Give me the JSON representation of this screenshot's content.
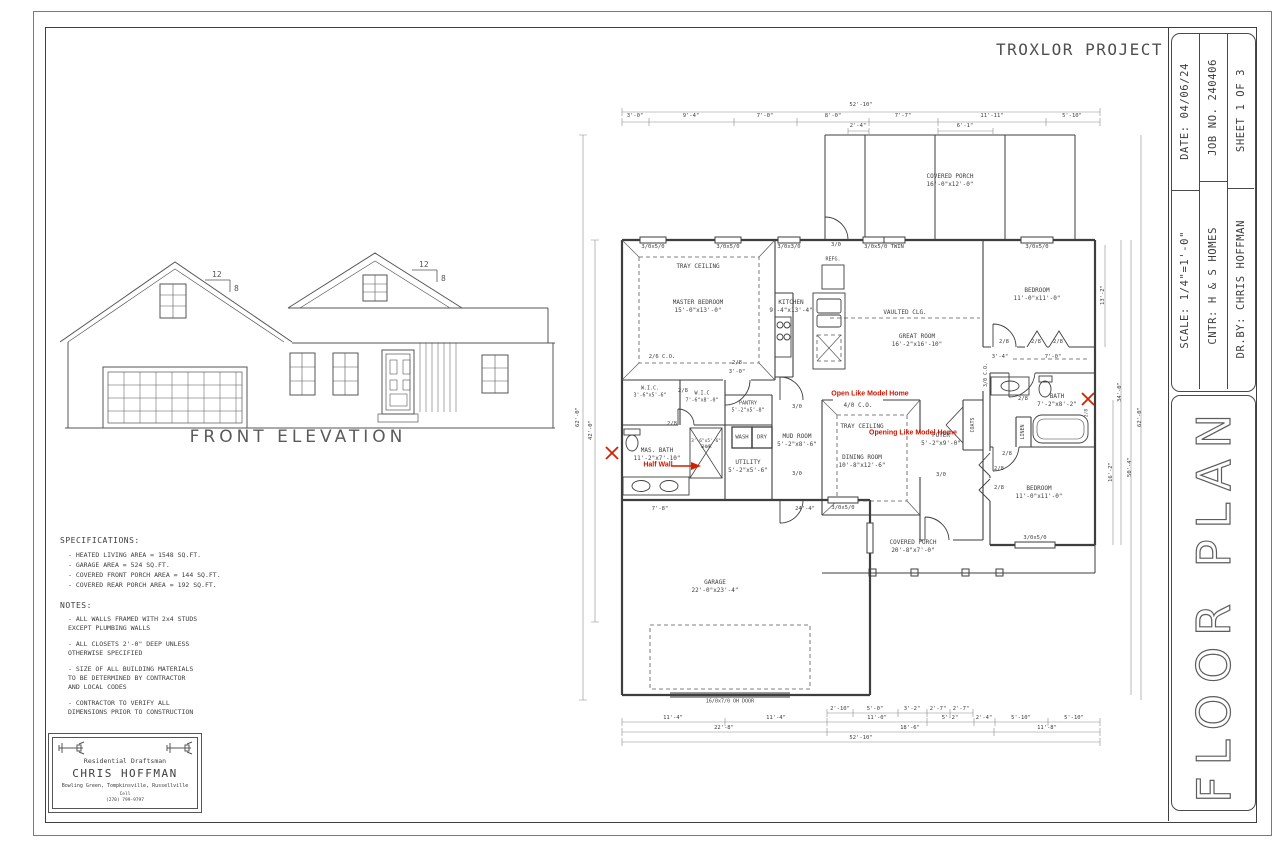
{
  "sheet": {
    "project_title": "TROXLOR PROJECT",
    "title_block": {
      "date_label": "DATE: 04/06/24",
      "job_label": "JOB NO. 240406",
      "sheet_label": "SHEET 1 OF 3",
      "scale_label": "SCALE: 1/4\"=1'-0\"",
      "contractor_label": "CNTR: H & S HOMES",
      "drawn_by_label": "DR.BY: CHRIS HOFFMAN",
      "drawing_title": "FLOOR PLAN"
    },
    "elevation": {
      "label": "FRONT ELEVATION",
      "pitch_rise": "12",
      "pitch_run": "8"
    },
    "specifications": {
      "heading": "SPECIFICATIONS:",
      "items": [
        "- HEATED LIVING AREA = 1548 SQ.FT.",
        "- GARAGE AREA = 524 SQ.FT.",
        "- COVERED FRONT PORCH AREA = 144 SQ.FT.",
        "- COVERED REAR PORCH AREA = 192 SQ.FT."
      ]
    },
    "notes": {
      "heading": "NOTES:",
      "items": [
        "- ALL WALLS FRAMED WITH 2x4 STUDS\n  EXCEPT PLUMBING WALLS",
        "- ALL CLOSETS 2'-0\" DEEP UNLESS\n  OTHERWISE SPECIFIED",
        "- SIZE OF ALL BUILDING MATERIALS\n  TO BE DETERMINED BY CONTRACTOR\n  AND LOCAL CODES",
        "- CONTRACTOR TO VERIFY ALL\n  DIMENSIONS PRIOR TO CONSTRUCTION"
      ]
    },
    "stamp": {
      "title": "Residential Draftsman",
      "name": "CHRIS HOFFMAN",
      "cities": "Bowling Green, Tompkinsville, Russellville",
      "phone_label": "Cell",
      "phone": "(270) 799-9797"
    },
    "plan": {
      "rooms": {
        "covered_porch_rear": {
          "name": "COVERED PORCH",
          "size": "16'-0\"x12'-0\""
        },
        "master_bedroom": {
          "name": "MASTER BEDROOM",
          "size": "15'-0\"x13'-0\"",
          "ceiling": "TRAY CEILING"
        },
        "kitchen": {
          "name": "KITCHEN",
          "size": "9'-4\"x13'-4\""
        },
        "great_room": {
          "name": "GREAT ROOM",
          "size": "16'-2\"x16'-10\"",
          "ceiling": "VAULTED CLG."
        },
        "bedroom_upper": {
          "name": "BEDROOM",
          "size": "11'-0\"x11'-0\""
        },
        "bedroom_lower": {
          "name": "BEDROOM",
          "size": "11'-0\"x11'-0\""
        },
        "bath": {
          "name": "BATH",
          "size": "7'-2\"x8'-2\""
        },
        "linen": "LINEN",
        "coats": "COATS",
        "foyer": {
          "name": "FOYER",
          "size": "5'-2\"x9'-0\""
        },
        "dining": {
          "name": "DINING ROOM",
          "size": "10'-8\"x12'-6\"",
          "ceiling": "TRAY CEILING",
          "opening": "4/0 C.O."
        },
        "mud_room": {
          "name": "MUD ROOM",
          "size": "5'-2\"x8'-6\""
        },
        "utility": {
          "name": "UTILITY",
          "size": "5'-2\"x5'-6\""
        },
        "pantry": {
          "name": "PANTRY",
          "size": "5'-2\"x5'-8\""
        },
        "wash": "WASH",
        "dry": "DRY",
        "wic_small": {
          "name": "W.I.C.",
          "size": "3'-6\"x5'-6\""
        },
        "wic_large": {
          "name": "W.I.C",
          "size": "7'-6\"x8'-0\""
        },
        "master_bath": {
          "name": "MAS. BATH",
          "size": "11'-2\"x7'-10\""
        },
        "shower": {
          "name": "SHWR",
          "size": "3'-6\"x5'-6\""
        },
        "garage": {
          "name": "GARAGE",
          "size": "22'-0\"x23'-4\"",
          "oh_door": "16/0x7/0 OH DOOR"
        },
        "covered_porch_front": {
          "name": "COVERED PORCH",
          "size": "20'-8\"x7'-0\""
        },
        "refg": "REFG."
      },
      "annotations": {
        "open1": "Open Like Model Home",
        "open2": "Opening Like Model Home",
        "half_wall": "Half Wall"
      },
      "window_labels": {
        "w3050": "3/0x5/0",
        "w3050twin": "3/0x5/0 TWIN",
        "w3030": "3/0x3/0"
      },
      "door_labels": {
        "d28": "2/8",
        "d30": "3/0",
        "d26co": "2/6 C.O.",
        "d40co": "4/0 C.O.",
        "d30co": "3/0 C.O.",
        "d3ft": "3'-0\""
      },
      "dimensions": {
        "overall_width": "52'-10\"",
        "top": [
          "3'-0\"",
          "9'-4\"",
          "7'-0\"",
          "8'-0\"",
          "7'-7\"",
          "11'-11\"",
          "5'-10\""
        ],
        "top_sub": [
          "2'-4\"",
          "6'-1\""
        ],
        "bottom_t1": [
          "2'-10\"",
          "5'-0\"",
          "3'-2\"",
          "2'-7\"",
          "2'-7\""
        ],
        "bottom_t2": [
          "11'-4\"",
          "11'-4\"",
          "11'-0\"",
          "5'-2\"",
          "2'-4\"",
          "5'-10\"",
          "5'-10\""
        ],
        "bottom_t3": [
          "22'-8\"",
          "18'-6\"",
          "11'-8\""
        ],
        "left": [
          "62'-0\"",
          "42'-0\""
        ],
        "right": [
          "13'-2\"",
          "16'-2\"",
          "34'-0\"",
          "50'-4\"",
          "62'-0\""
        ],
        "misc": [
          "3'-4\"",
          "7'-0\"",
          "7'-8\"",
          "24'-4\""
        ]
      }
    }
  },
  "colors": {
    "line": "#3e3e3e",
    "red": "#cc1400"
  }
}
